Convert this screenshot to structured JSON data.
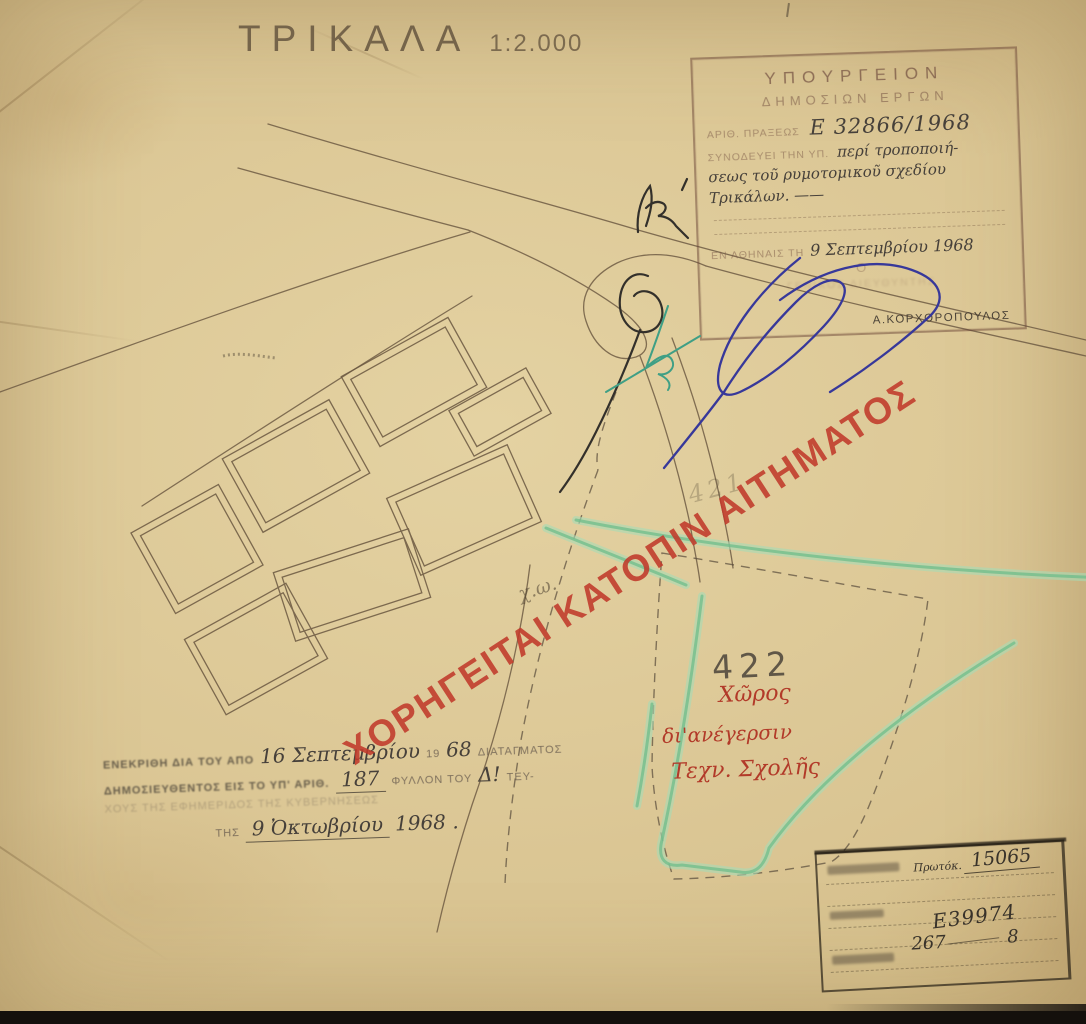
{
  "page": {
    "title": "ΤΡΙΚΑΛΑ",
    "scale": "1:2.000"
  },
  "ministry_stamp": {
    "org_line1": "ΥΠΟΥΡΓΕΙΟΝ",
    "org_line2": "ΔΗΜΟΣΙΩΝ ΕΡΓΩΝ",
    "praxis_label": "ΑΡΙΘ. ΠΡΑΞΕΩΣ",
    "praxis_value": "Ε 32866/1968",
    "accompany_label": "ΣΥΝΟΔΕΥΕΙ ΤΗΝ ΥΠ.",
    "accompany_hand_1": "περί τροποποιή-",
    "accompany_hand_2": "σεως τοῦ ρυμοτομικοῦ σχεδίου",
    "accompany_hand_3": "Τρικάλων. ——",
    "place_date_label": "ΕΝ ΑΘΗΝΑΙΣ ΤΗ",
    "place_date_value": "9 Σεπτεμβρίου 1968",
    "omicron": "Ο",
    "faded_role_line": "ΓΕΝΙΚΟΣ ΔΙΕΥΘΥΝΤΗΣ",
    "signatory_name": "Α.ΚΟΡΧΟΡΟΠΟΥΛΟΣ"
  },
  "red_stamp": {
    "text": "ΧΟΡΗΓΕΙΤΑΙ ΚΑΤΟΠΙΝ ΑΙΤΗΜΑΤΟΣ"
  },
  "parcel": {
    "number": "422",
    "line1": "Χῶρος",
    "line2": "δι'ανέγερσιν",
    "line3": "Τεχν. Σχολῆς"
  },
  "pencil_notes": {
    "note1": "χ.ω.",
    "note2": "421"
  },
  "approval_stamp": {
    "l1_stamp_a": "ΕΝΕΚΡΙΘΗ ΔΙΑ ΤΟΥ ΑΠΟ",
    "l1_hand_a": "16 Σεπτεμβρίου",
    "l1_stamp_b": "19",
    "l1_hand_b": "68",
    "l1_stamp_c": "ΔΙΑΤΑΓΜΑΤΟΣ",
    "l2_stamp_a": "ΔΗΜΟΣΙΕΥΘΕΝΤΟΣ ΕΙΣ ΤΟ ΥΠ' ΑΡΙΘ.",
    "l2_hand_a": "187",
    "l2_stamp_b": "ΦΥΛΛΟΝ ΤΟΥ",
    "l2_hand_b": "Δ!",
    "l2_stamp_c": "ΤΕΥ-",
    "l3_stamp": "ΧΟΥΣ ΤΗΣ ΕΦΗΜΕΡΙΔΟΣ ΤΗΣ ΚΥΒΕΡΝΗΣΕΩΣ",
    "l4_stamp": "ΤΗΣ",
    "l4_hand_a": "9 Ὀκτωβρίου",
    "l4_hand_b": "1968 ."
  },
  "registry_stamp": {
    "protocol_label": "Πρωτόκ.",
    "protocol_value": "15065",
    "value_e": "Ε39974",
    "value_row_a": "267",
    "value_row_b": "8"
  },
  "colors": {
    "paper": "#d9c48f",
    "map_ink": "#6b5841",
    "red_stamp": "#c13a2b",
    "green_marker": "#8bcd9f",
    "blue_ink": "#37389a",
    "pencil": "#4b443a"
  }
}
